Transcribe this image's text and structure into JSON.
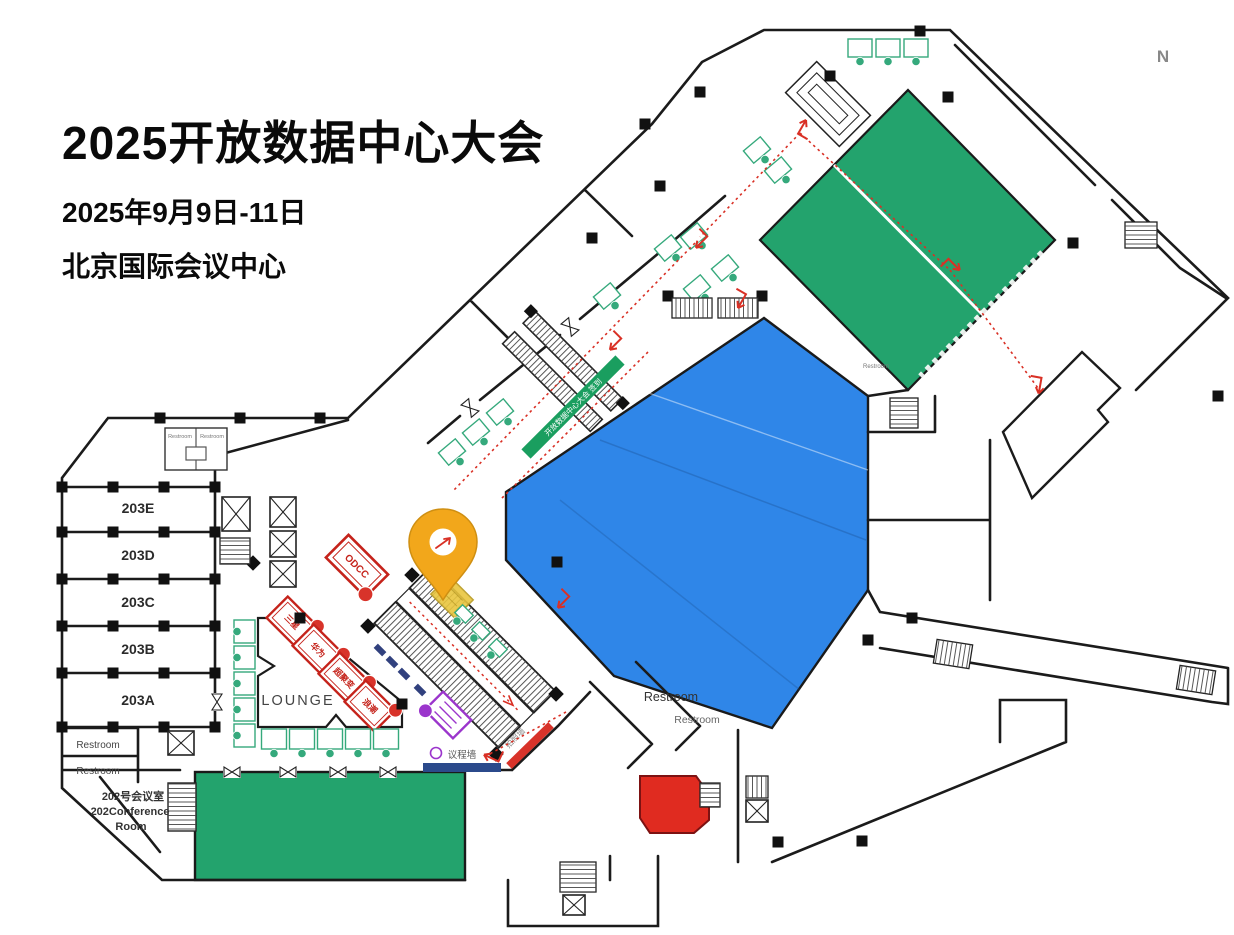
{
  "header": {
    "title": "2025开放数据中心大会",
    "date": "2025年9月9日-11日",
    "venue": "北京国际会议中心"
  },
  "compass_label": "N",
  "rooms": {
    "r203e": "203E",
    "r203d": "203D",
    "r203c": "203C",
    "r203b": "203B",
    "r203a": "203A",
    "r202_cn": "202号会议室",
    "r202_en1": "202Conference",
    "r202_en2": "Room",
    "lounge": "LOUNGE"
  },
  "walls_labels": {
    "agenda": "议程墙",
    "photo": "拍照墙",
    "checkin": "开放数据中心大会 签到"
  },
  "restroom_label": "Restroom",
  "booths": {
    "odcc": "ODCC",
    "red": [
      {
        "name": "三星"
      },
      {
        "name": "华为"
      },
      {
        "name": "超聚变"
      },
      {
        "name": "浪潮"
      }
    ]
  },
  "colors": {
    "hall_blue": "#2F86E8",
    "hall_green": "#23A36D",
    "room_red": "#E02B20",
    "booth_red": "#C5231B",
    "booth_green": "#35A97C",
    "booth_purple": "#9B35CC",
    "pin_yellow": "#F2A71B",
    "route_red": "#D93025",
    "agenda_blue": "#2B4A8B"
  }
}
